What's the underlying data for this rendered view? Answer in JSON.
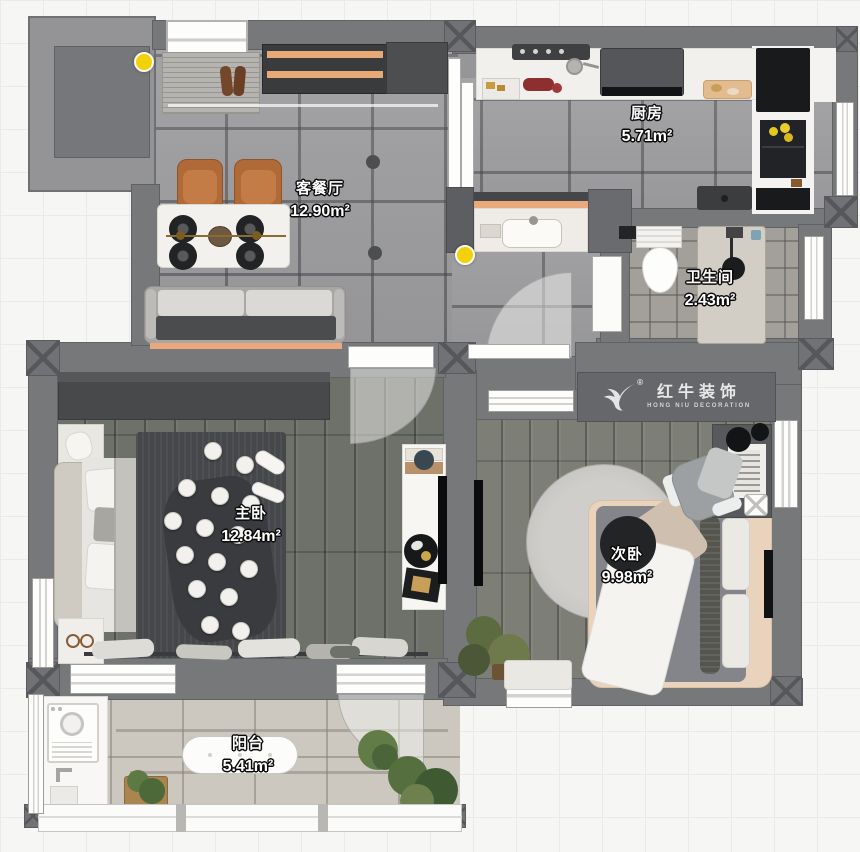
{
  "rooms": [
    {
      "id": "living-dining",
      "name": "客餐厅",
      "area": "12.90m²"
    },
    {
      "id": "kitchen",
      "name": "厨房",
      "area": "5.71m²"
    },
    {
      "id": "bathroom",
      "name": "卫生间",
      "area": "2.43m²"
    },
    {
      "id": "master-bedroom",
      "name": "主卧",
      "area": "12.84m²"
    },
    {
      "id": "second-bedroom",
      "name": "次卧",
      "area": "9.98m²"
    },
    {
      "id": "balcony",
      "name": "阳台",
      "area": "5.41m²"
    }
  ],
  "logo": {
    "registered": "®",
    "name_cn": "红牛装饰",
    "name_en": "HONG NIU DECORATION"
  },
  "icons": {
    "brand_mark": "hongniu-bull-icon"
  },
  "colors": {
    "wall_gray": "#77787A",
    "accent_orange": "#E9A97B",
    "indicator_yellow": "#F3D109",
    "marble_floor": "#9D9DA0",
    "wood_floor": "#6E706A",
    "balcony_floor": "#CCC8C0",
    "logo_banner": "#66676A"
  }
}
